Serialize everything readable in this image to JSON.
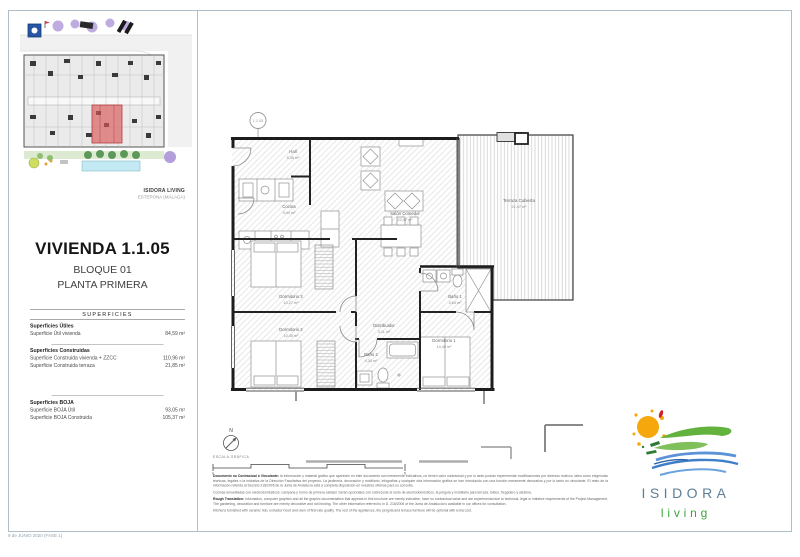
{
  "sheet": {
    "footer_note": "9 de JUNIO 2020 (FASE 1)"
  },
  "sidebar": {
    "brand_name": "ISIDORA LIVING",
    "brand_location": "ESTEPONA (MÁLAGA)",
    "unit_title": "VIVIENDA 1.1.05",
    "block": "BLOQUE 01",
    "floor": "PLANTA PRIMERA",
    "surfaces_header": "SUPERFICIES",
    "groups": [
      {
        "title": "Superficies Útiles",
        "rows": [
          {
            "label": "Superficie Útil vivienda",
            "value": "84,59 m²"
          }
        ]
      },
      {
        "title": "Superficies Construidas",
        "rows": [
          {
            "label": "Superficie Construida vivienda + ZZCC",
            "value": "110,96 m²"
          },
          {
            "label": "Superficie Construida terraza",
            "value": "21,85 m²"
          }
        ]
      },
      {
        "title": "Superficies BOJA",
        "rows": [
          {
            "label": "Superficie BOJA Útil",
            "value": "93,05 m²"
          },
          {
            "label": "Superficie BOJA Construida",
            "value": "105,37 m²"
          }
        ]
      }
    ]
  },
  "plan": {
    "unit_marker": "1.1.05",
    "north_label": "N",
    "scale_label": "ESCALA GRÁFICA",
    "scale_min": "0",
    "scale_max": "5",
    "rooms": [
      {
        "name": "Hall",
        "area": "5,35 m²"
      },
      {
        "name": "Cocina",
        "area": "9,44 m²"
      },
      {
        "name": "Salón Comedor",
        "area": "22,47 m²"
      },
      {
        "name": "Terraza Cubierta",
        "area": "21,47 m²"
      },
      {
        "name": "Dormitorio 3",
        "area": "10,27 m²"
      },
      {
        "name": "Dormitorio 2",
        "area": "10,45 m²"
      },
      {
        "name": "Distribuidor",
        "area": "3,11 m²"
      },
      {
        "name": "Baño 2",
        "area": "4,30 m²"
      },
      {
        "name": "Baño 1",
        "area": "4,64 m²"
      },
      {
        "name": "Dormitorio 1",
        "area": "14,40 m²"
      }
    ]
  },
  "legal": {
    "es_lead": "Documento no Contractual ó Vinculante:",
    "es_body": "la información y material gráfico que aparecen en este documento son meramente indicativos, no tienen valor contractual y por lo tanto podrán experimentar modificaciones por diversos motivos, tales como exigencias técnicas, legales o la iniciativa de la Dirección Facultativa del proyecto. La jardinería, decoración y mobiliario, infografías y cualquier otra información gráfica se han introducido con una función meramente decorativa y por lo tanto no vinculante. El resto de la información referida al Decreto 218/2005 de la Junta de Andalucía está a completa disposición en nuestras oficinas para su consulta.",
    "es_note": "Cocinas amuebladas con electrodomésticos: campana y horno de primera calidad. Serán opcionales con sobrecoste el resto de electrodomésticos, la pérgola y mobiliario para terraza, toldos, fregadero y alzatina.",
    "en_lead": "Rough Translation:",
    "en_body": "Information, computer graphics and all the graphic documentation that appears in this brochure are merely indicative, have no contractual value and are experimental due to technical, legal or initiative requirements of the Project Management. The gardening, decoration and furniture are merely decorative and not binding. The other information referred to in D. 218/2005 of the Junta de Andalucía is available in our offices for consultation.",
    "en_note": "Kitchens furnished with ceramic hob, extractor hood and oven of first-rate quality. The rest of the appliances, the pergola and terrace furniture will be optional with extra cost."
  },
  "logo": {
    "name": "ISIDORA",
    "tagline": "living"
  },
  "colors": {
    "accent_red": "#dd7373",
    "frame": "#aebfca",
    "logo_blue": "#5d7f95",
    "logo_green": "#3fa33f",
    "sun_orange": "#f6a70b",
    "wave_blue": "#3f7ec9"
  }
}
